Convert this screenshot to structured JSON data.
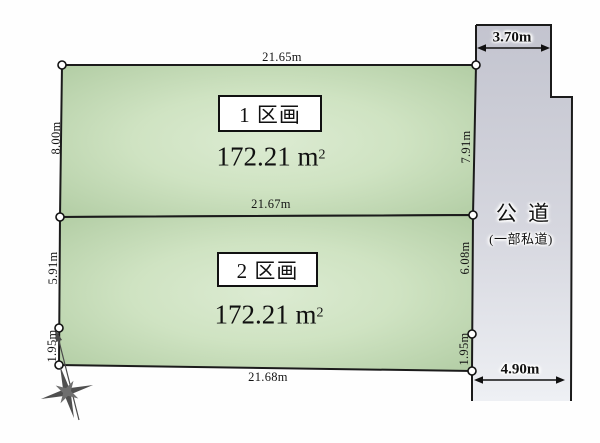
{
  "parcels": [
    {
      "label": "1 区画",
      "area_value": "172.21",
      "area_unit": "m",
      "area_exp": "2"
    },
    {
      "label": "2 区画",
      "area_value": "172.21",
      "area_unit": "m",
      "area_exp": "2"
    }
  ],
  "dimensions": {
    "top_width": "21.65m",
    "middle_width": "21.67m",
    "bottom_width": "21.68m",
    "left": [
      "8.00m",
      "5.91m",
      "1.95m"
    ],
    "right": [
      "7.91m",
      "6.08m",
      "1.95m"
    ]
  },
  "road": {
    "name": "公 道",
    "note": "(一部私道)",
    "top_width": "3.70m",
    "bottom_width": "4.90m"
  },
  "colors": {
    "parcel_center": "#d7e7cc",
    "parcel_edge": "#b1cca3",
    "road_top": "#c3c4cf",
    "road_bottom": "#eef0f4",
    "line": "#1b1b1b"
  }
}
